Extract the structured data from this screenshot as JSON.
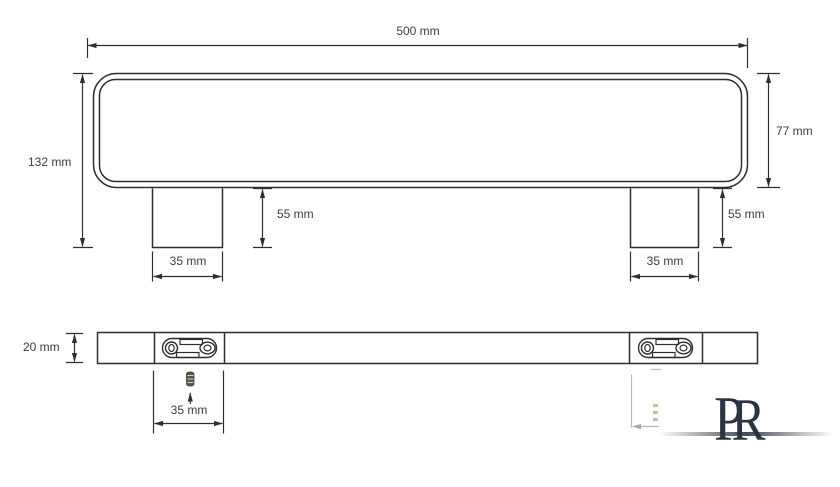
{
  "drawing": {
    "title": "shelf-technical-drawing",
    "side_view": {
      "total_width": "500 mm",
      "total_height": "132 mm",
      "body_height": "77 mm",
      "leg_height_left": "55 mm",
      "leg_height_right": "55 mm",
      "leg_width_left": "35 mm",
      "leg_width_right": "35 mm"
    },
    "bottom_view": {
      "bar_thickness": "20 mm",
      "plate_width": "35 mm"
    },
    "logo": {
      "letter_first": "P",
      "letter_second": "R"
    },
    "colors": {
      "line": "#2e2e2e",
      "faded_line": "#8a8a8a",
      "text": "#3d3d3d",
      "logo": "#2b3346",
      "screw": "#5a554d",
      "screw_faded": "#b98a52",
      "background": "#ffffff"
    }
  }
}
